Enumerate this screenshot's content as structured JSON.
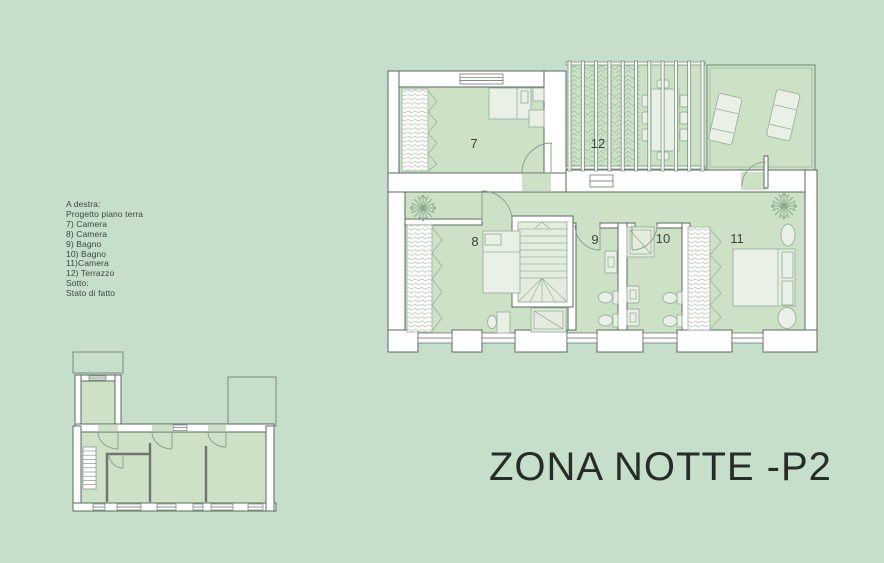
{
  "title": "ZONA NOTTE -P2",
  "legend": {
    "lines": [
      "A destra:",
      "Progetto piano terra",
      "7) Camera",
      "8) Camera",
      "9) Bagno",
      "10) Bagno",
      "11)Camera",
      "12) Terrazzo",
      "Sotto:",
      "Stato di fatto"
    ]
  },
  "plans": {
    "main": {
      "name": "Progetto piano terra",
      "rooms": [
        {
          "number": "7",
          "type": "Camera"
        },
        {
          "number": "8",
          "type": "Camera"
        },
        {
          "number": "9",
          "type": "Bagno"
        },
        {
          "number": "10",
          "type": "Bagno"
        },
        {
          "number": "11",
          "type": "Camera"
        },
        {
          "number": "12",
          "type": "Terrazzo"
        }
      ]
    },
    "small": {
      "name": "Stato di fatto"
    }
  },
  "colors": {
    "background": "#c6dfca",
    "room_fill": "#cce1c6",
    "wall_stroke": "#5a6a5e",
    "furniture_stroke": "#9bb29d",
    "furniture_fill": "#e9f0e5",
    "title_text": "#262d25",
    "legend_text": "#3c463d"
  }
}
